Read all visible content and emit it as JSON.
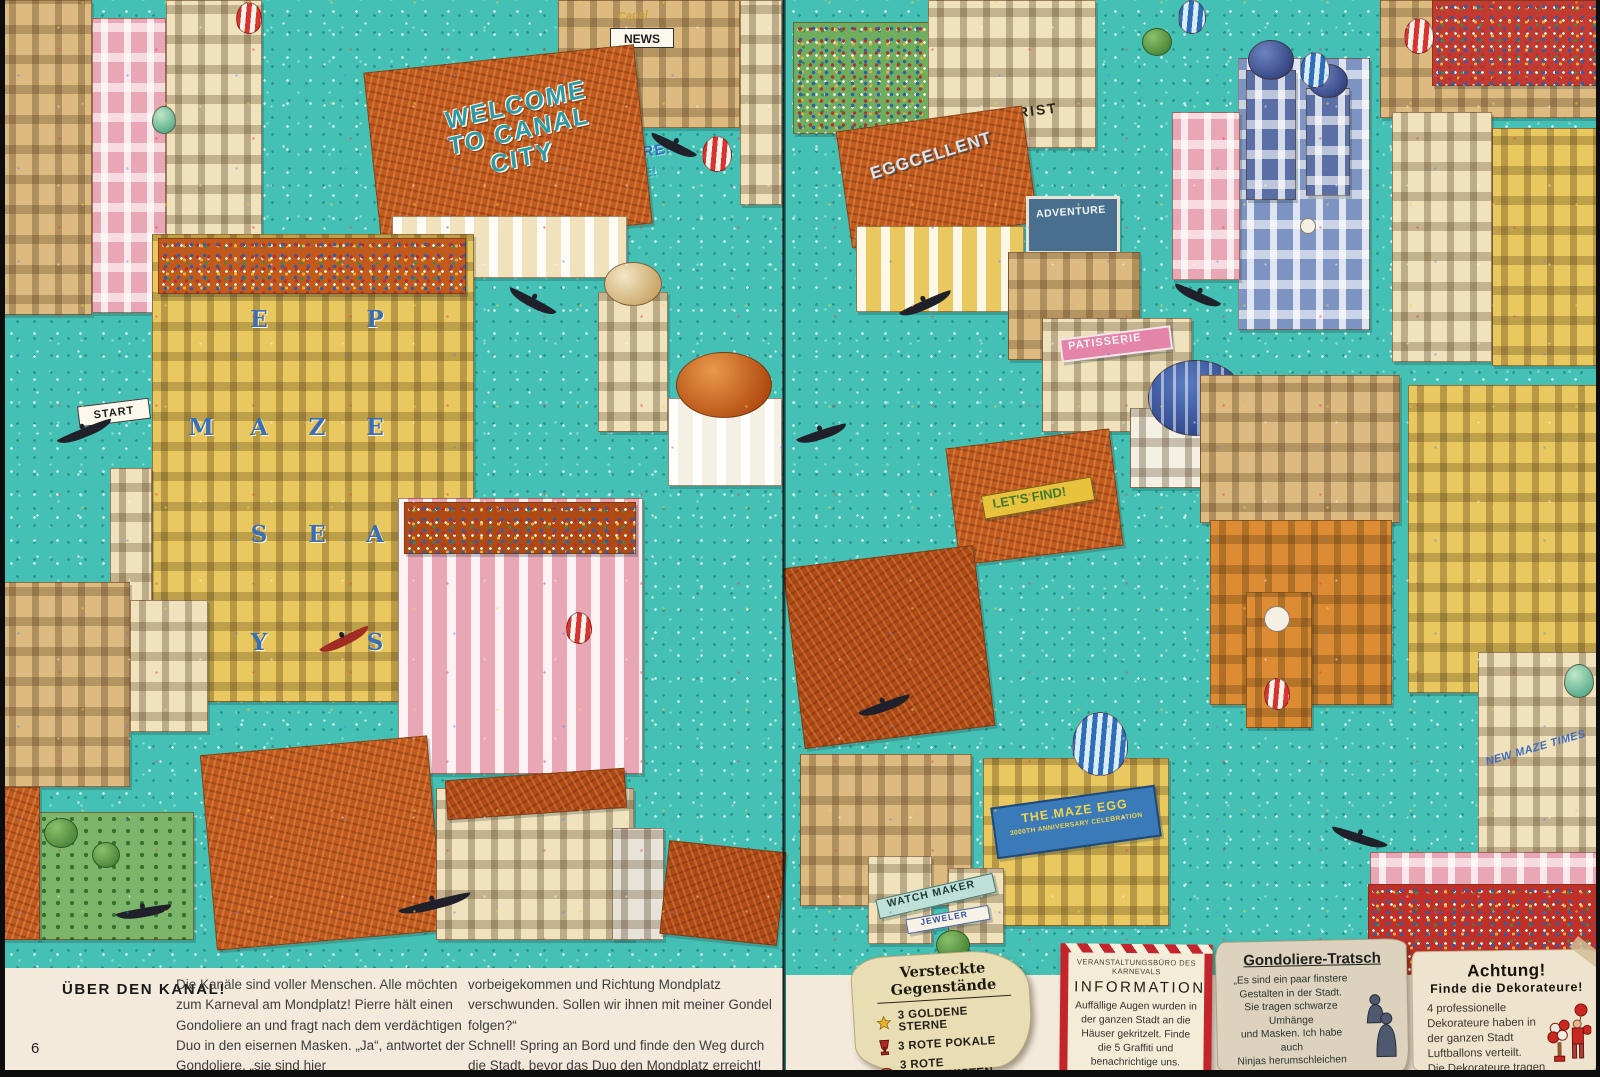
{
  "book": {
    "left_page_number": "6",
    "heading": "ÜBER DEN KANAL!",
    "intro_col1": "Die Kanäle sind voller Menschen. Alle möchten zum Karneval am Mondplatz! Pierre hält einen Gondoliere an und fragt nach dem verdächtigen Duo in den eisernen Masken. „Ja“, antwortet der Gondoliere, „sie sind hier",
    "intro_col2": "vorbeigekommen und Richtung Mondplatz verschwunden. Sollen wir ihnen mit meiner Gondel folgen?“\nSchnell! Spring an Bord und finde den Weg durch die Stadt, bevor das Duo den Mondplatz erreicht!"
  },
  "notes": {
    "hidden_items": {
      "title": "Versteckte Gegenstände",
      "items": [
        {
          "icon": "gold-star-icon",
          "label": "3 GOLDENE STERNE"
        },
        {
          "icon": "red-trophy-icon",
          "label": "3 ROTE POKALE"
        },
        {
          "icon": "red-chest-icon",
          "label": "3 ROTE SCHATZKISTEN"
        }
      ]
    },
    "information": {
      "office": "VERANSTALTUNGSBÜRO DES KARNEVALS",
      "title": "INFORMATION",
      "body": "Auffällige Augen wurden in der ganzen Stadt an die Häuser gekritzelt. Finde die 5 Graffiti und benachrichtige uns.",
      "icon": "eye-with-lashes-icon"
    },
    "gossip": {
      "title": "Gondoliere-Tratsch",
      "body": "„Es sind ein paar finstere\nGestalten in der Stadt.\nSie tragen schwarze Umhänge\nund Masken. Ich habe auch\nNinjas herumschleichen sehen.\nEiner ist in Rot gekleidet.\nWas sie wohl vorhaben?\nKannst du sie entdecken?“",
      "icon": "cloaked-figures-icon"
    },
    "attention": {
      "title": "Achtung!",
      "subtitle": "Finde die Dekorateure!",
      "body": "4 professionelle Dekorateure haben in der ganzen Stadt Luftballons verteilt.\nDie Dekorateure tragen gestreifte Kleidung.\nWo sind sie?",
      "icon": "decorator-with-balloons-icon"
    }
  },
  "illustration": {
    "signs": {
      "welcome": "WELCOME TO CANAL CITY",
      "start": "START",
      "canal_script": "Canal",
      "news": "NEWS",
      "come_here": "COME HERE!",
      "florist": "FLORIST",
      "eggcellent": "EGGCELLENT",
      "adventure": "ADVENTURE",
      "patisserie": "PATISSERIE",
      "lets_find": "LET'S FIND!",
      "watch_maker": "WATCH MAKER",
      "jeweler": "JEWELER",
      "new_maze_times": "NEW MAZE TIMES",
      "maze_egg_line1": "THE MAZE EGG",
      "maze_egg_line2": "3000TH ANNIVERSARY CELEBRATION"
    },
    "maze_letters": [
      "E",
      "P",
      "M",
      "A",
      "Z",
      "E",
      "S",
      "E",
      "A",
      "Y",
      "S"
    ],
    "colors": {
      "water": "#45c0b4",
      "roof_orange": "#c25a1c",
      "paper_cream": "#f3eadb",
      "accent_red": "#c4242c"
    }
  }
}
